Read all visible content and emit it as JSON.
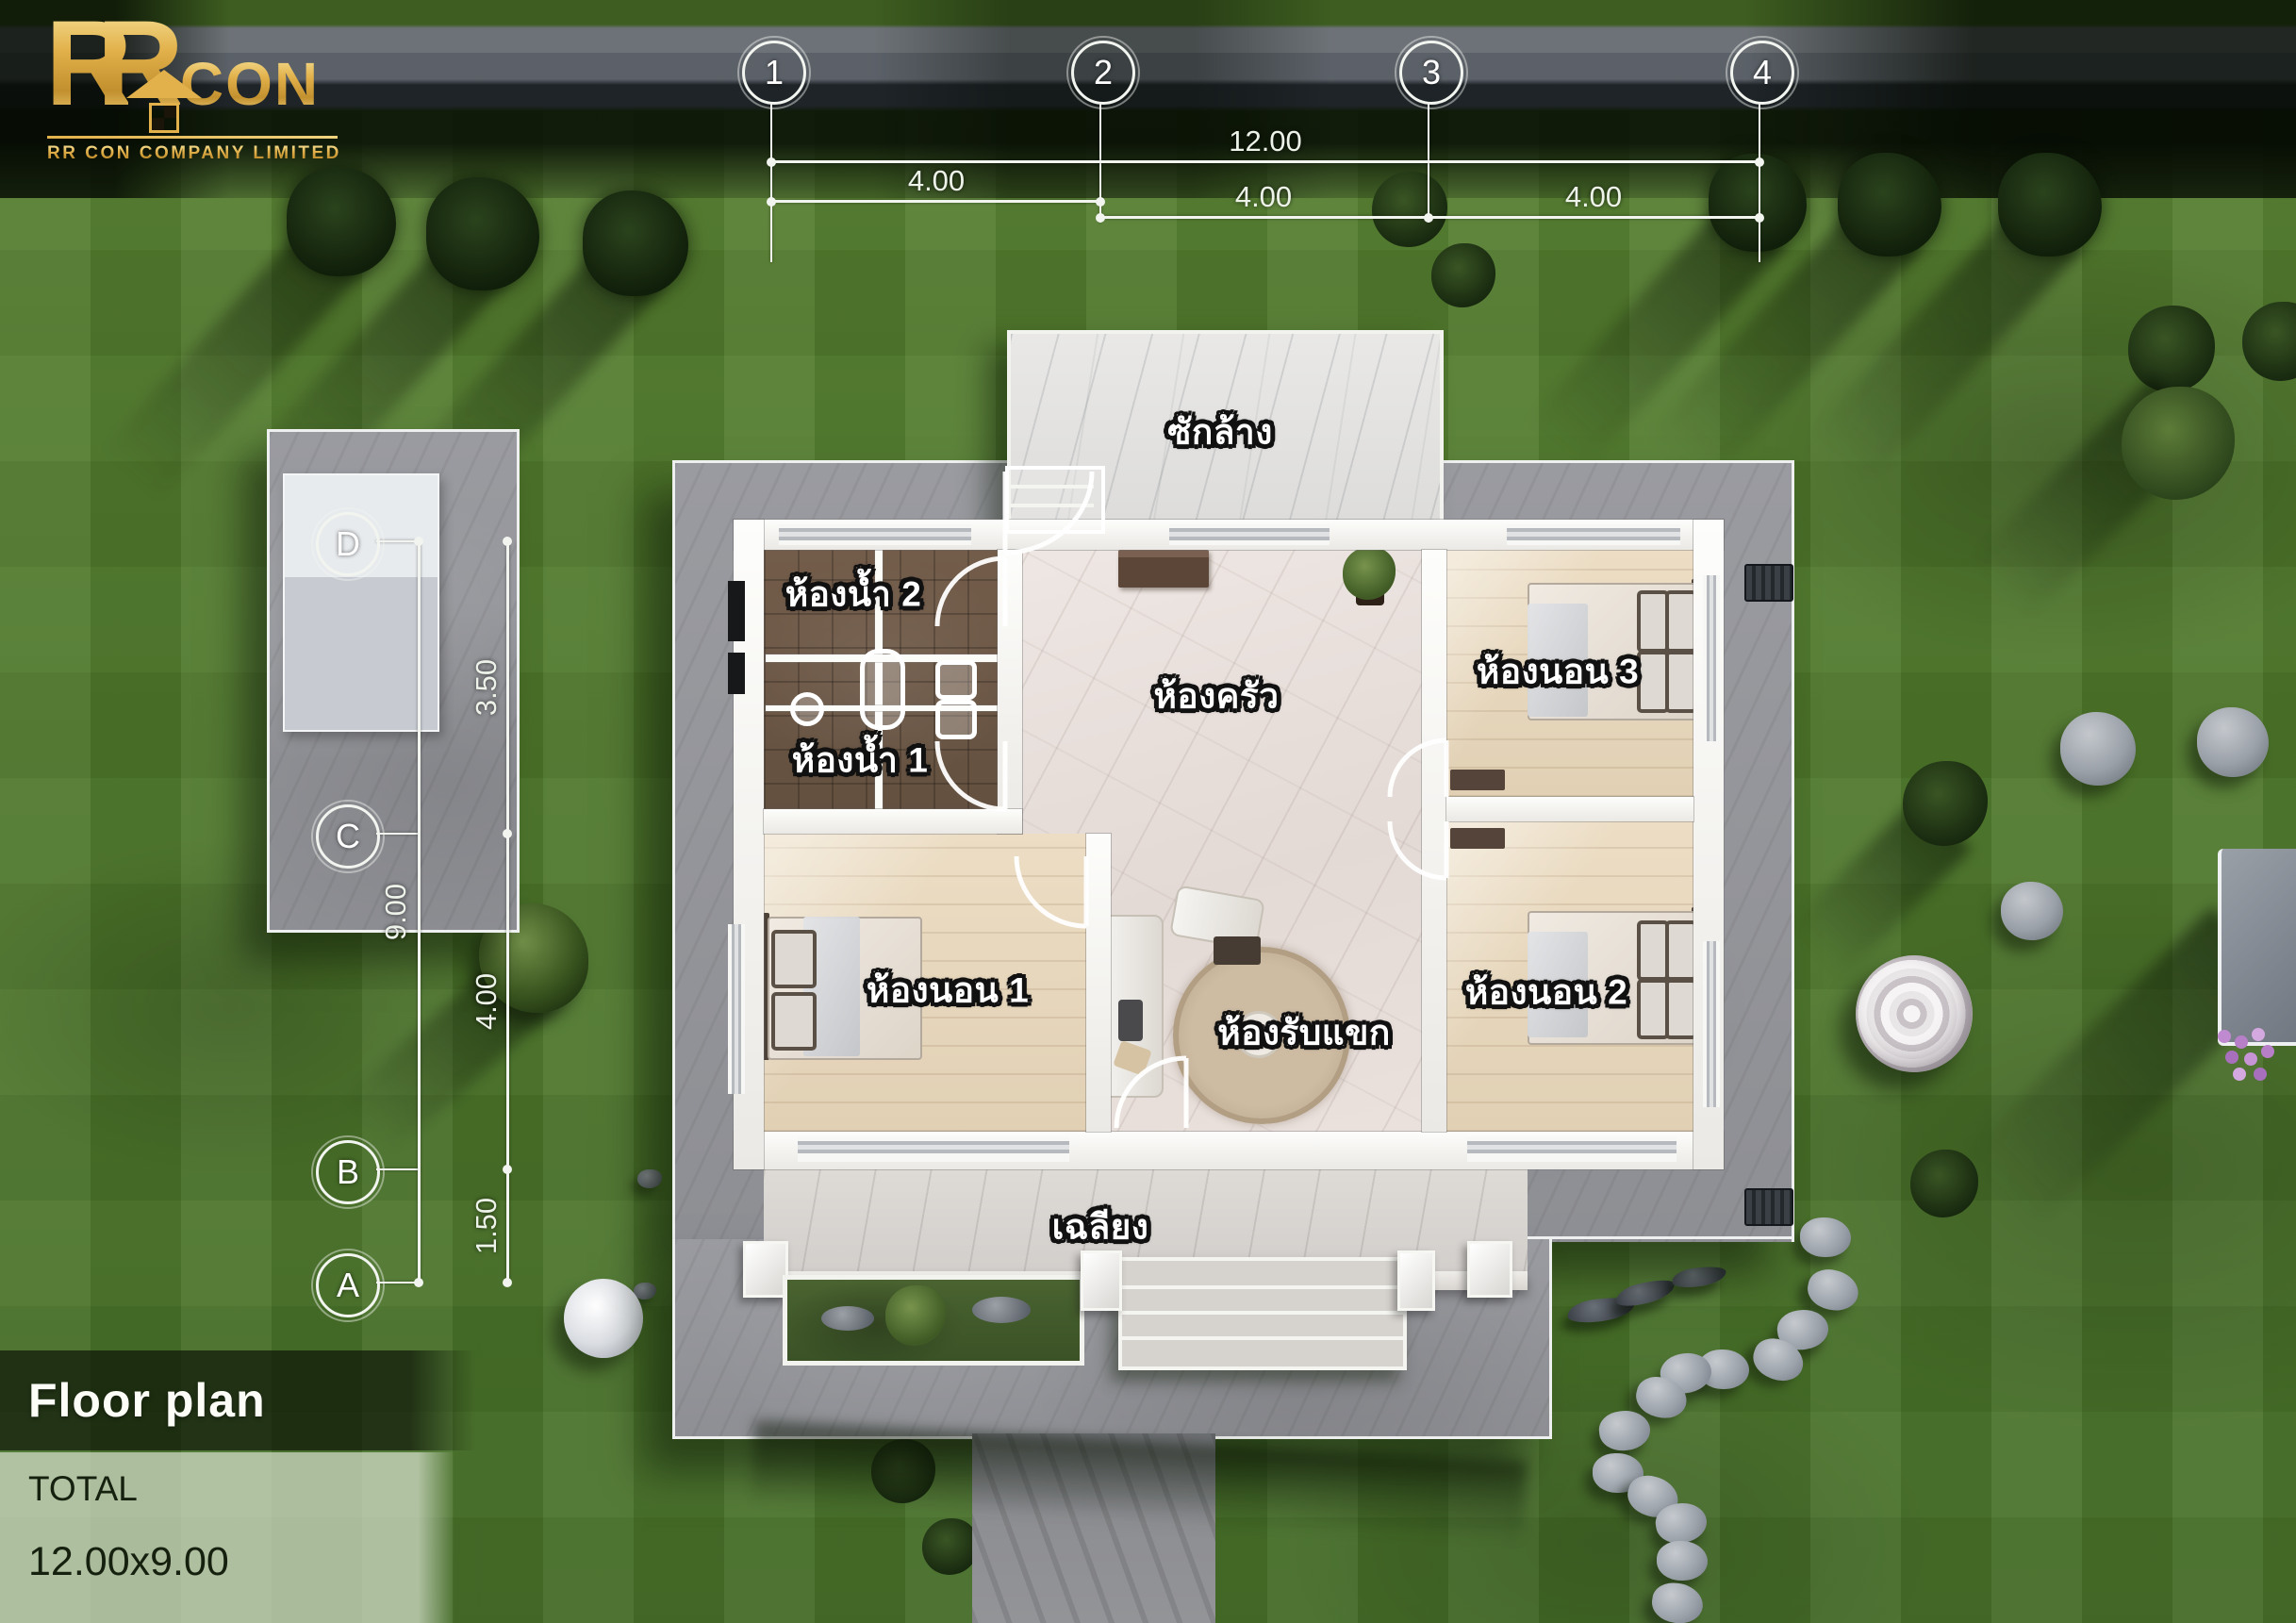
{
  "brand": {
    "r1": "R",
    "r2": "R",
    "con": "CON",
    "company": "RR CON COMPANY LIMITED"
  },
  "title_block": {
    "title": "Floor plan",
    "total_label": "TOTAL",
    "total_value": "12.00x9.00"
  },
  "grid": {
    "columns": [
      "1",
      "2",
      "3",
      "4"
    ],
    "rows": [
      "D",
      "C",
      "B",
      "A"
    ]
  },
  "dimensions": {
    "top_overall": "12.00",
    "top_seg1": "4.00",
    "top_seg2": "4.00",
    "top_seg3": "4.00",
    "left_overall": "9.00",
    "left_seg1": "3.50",
    "left_seg2": "4.00",
    "left_seg3": "1.50"
  },
  "rooms": {
    "laundry": "ซักล้าง",
    "bath2": "ห้องน้ำ 2",
    "bath1": "ห้องน้ำ 1",
    "kitchen": "ห้องครัว",
    "bed3": "ห้องนอน 3",
    "bed1": "ห้องนอน 1",
    "living": "ห้องรับแขก",
    "bed2": "ห้องนอน 2",
    "porch": "เฉลียง"
  },
  "colors": {
    "logo_gold": "#e2b14b",
    "grass": "#4f7a2b",
    "roof_slab": "#95969b",
    "wall_white": "#f8f8f5",
    "label_text": "#ffffff",
    "label_outline": "#111111",
    "dim_text": "#eef3ea"
  }
}
